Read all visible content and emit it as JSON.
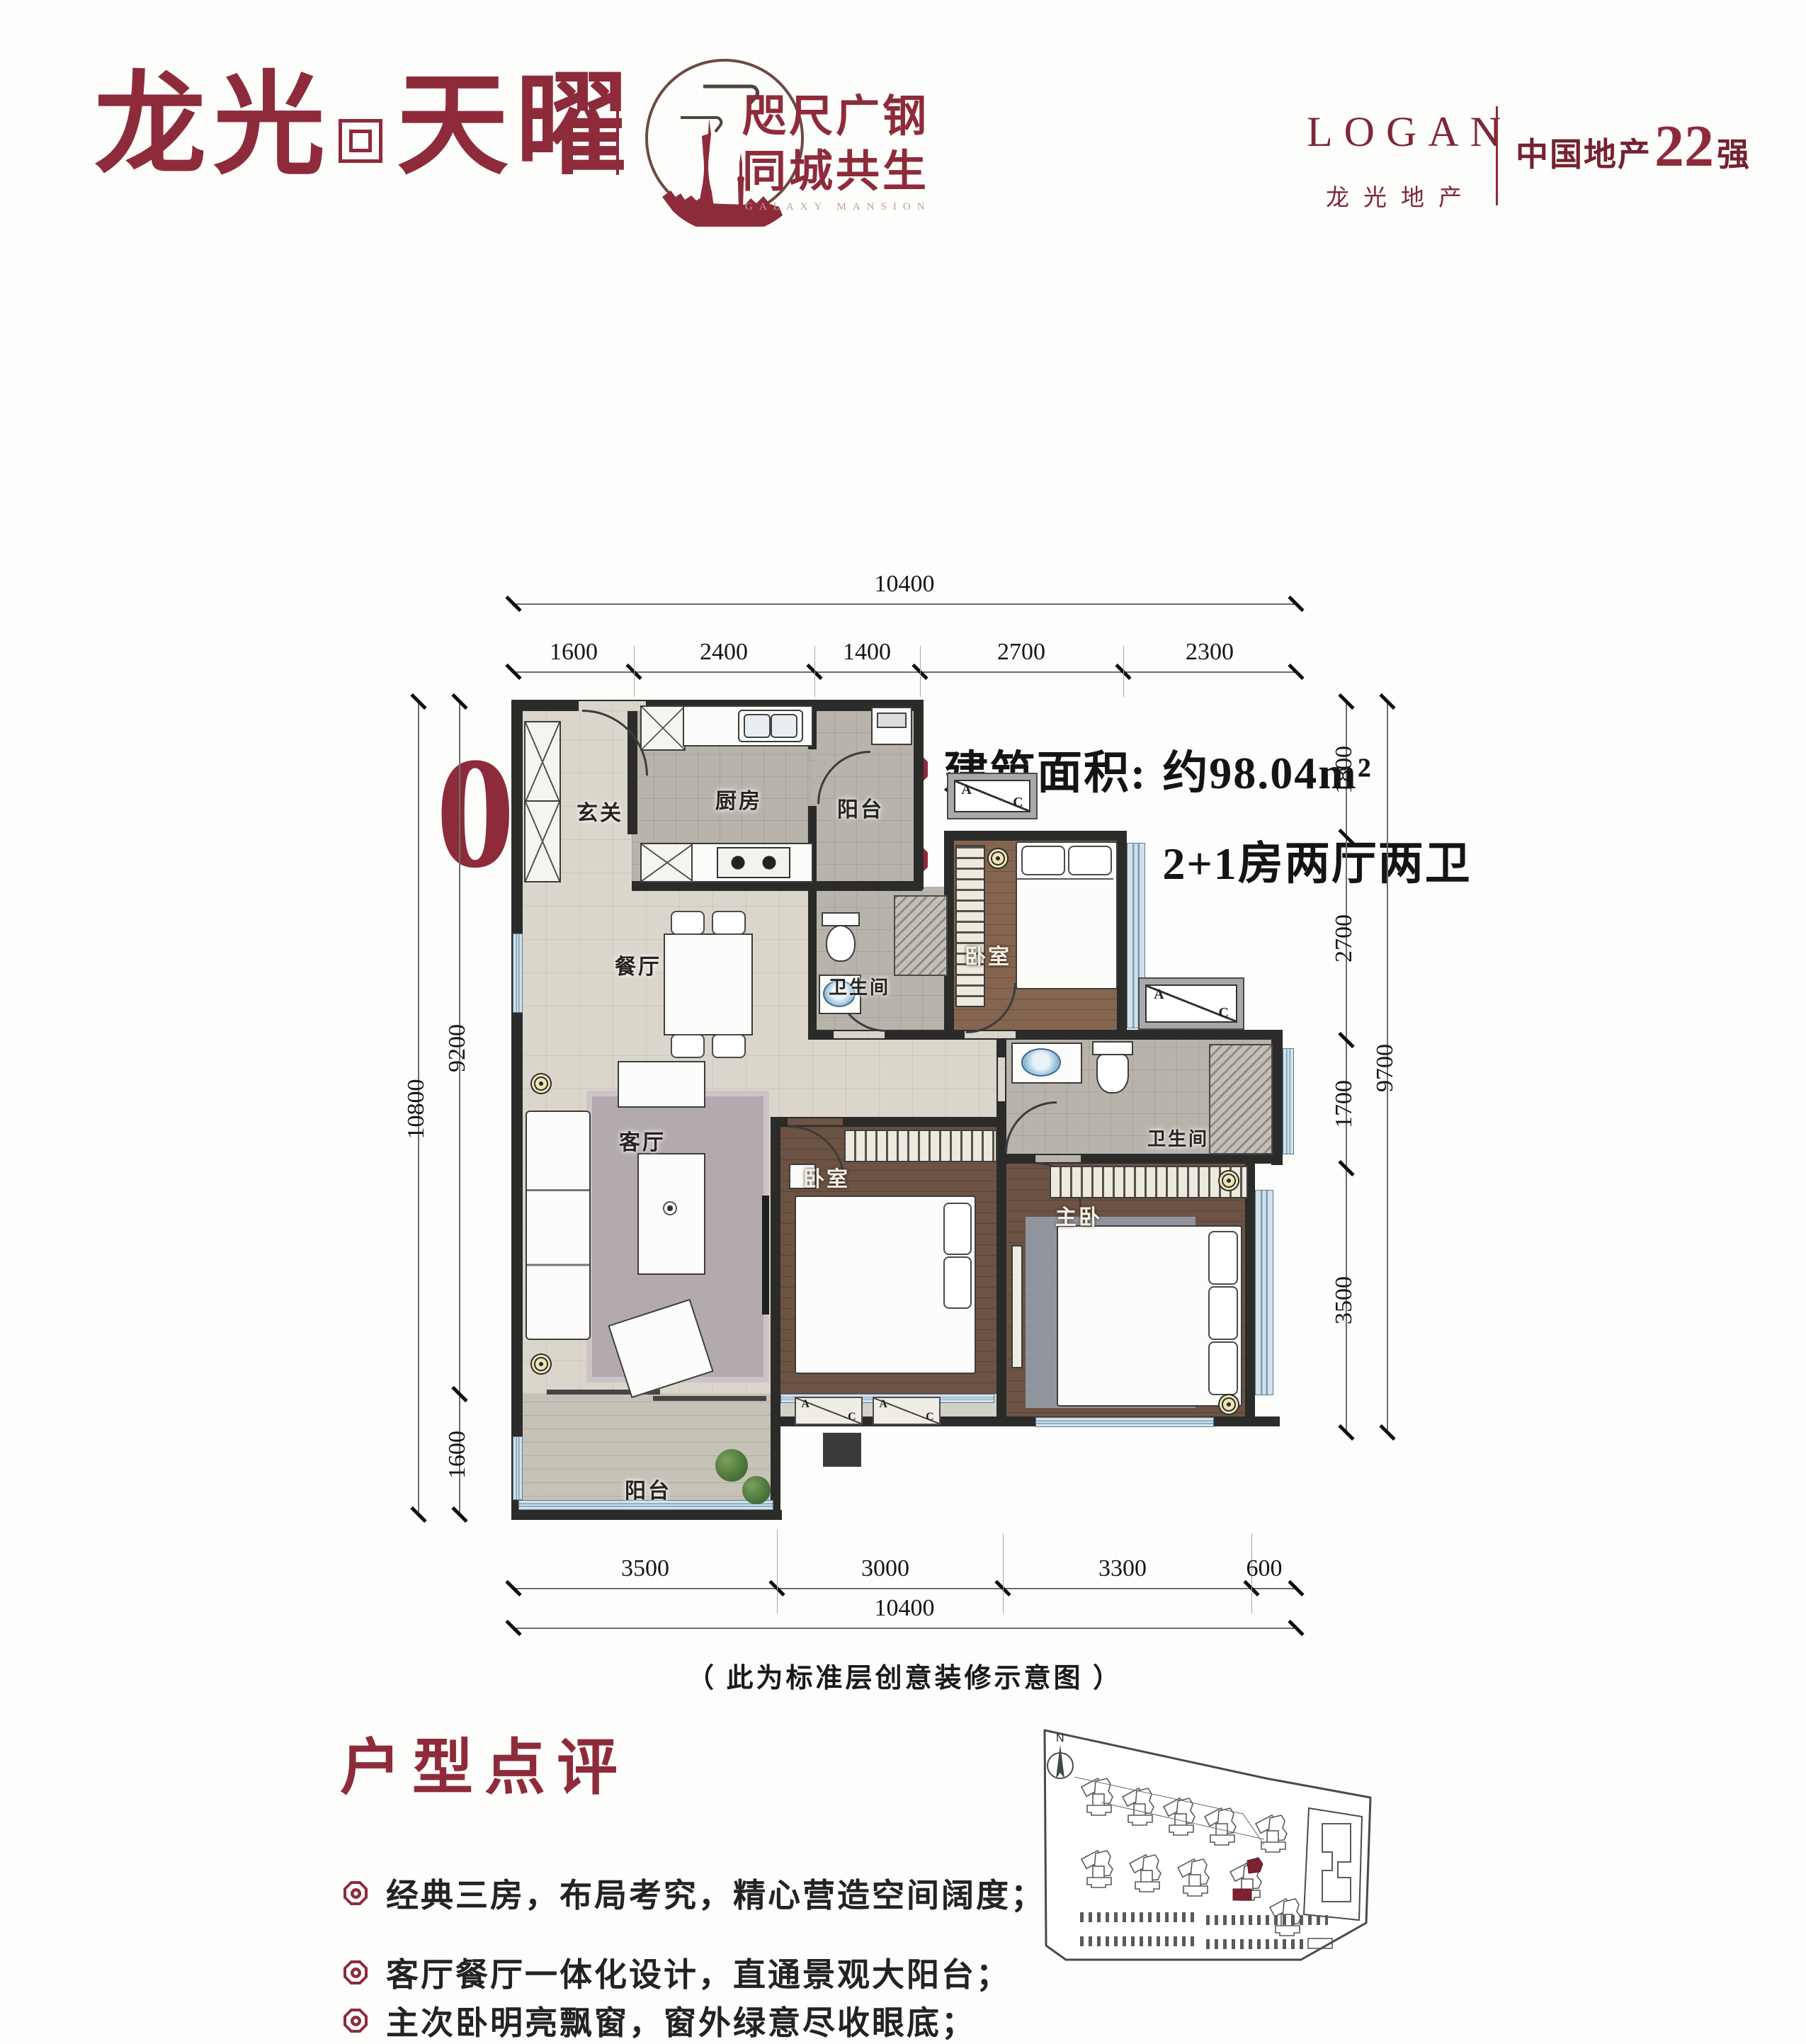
{
  "header": {
    "brand_first": "龙光",
    "brand_second": "天曜",
    "stamp": {
      "line1": "咫尺广钢",
      "line2": "同城共生",
      "subtitle": "GALAXY MANSION"
    },
    "logan": {
      "name": "LOGAN",
      "sub": "龙光地产"
    },
    "rank": {
      "prefix": "中国地产",
      "number": "22",
      "suffix": "强"
    }
  },
  "title": {
    "unit": "02/05",
    "unit_type": "户型",
    "specs": [
      {
        "label": "建筑面积:",
        "value": "约98.04m²"
      },
      {
        "label": "户型格局:",
        "value": "2+1房两厅两卫"
      }
    ]
  },
  "plan": {
    "rooms": {
      "entry": "玄关",
      "kitchen": "厨房",
      "balcony_top": "阳台",
      "bath_1": "卫生间",
      "dining": "餐厅",
      "living": "客厅",
      "bedroom_1": "卧室",
      "bedroom_2": "卧室",
      "master": "主卧",
      "bath_2": "卫生间",
      "balcony": "阳台"
    },
    "ac_a": "A",
    "ac_c": "C",
    "compass": "N",
    "note": "（ 此为标准层创意装修示意图 ）"
  },
  "dims": {
    "top_total": "10400",
    "top_segments": [
      "1600",
      "2400",
      "1400",
      "2700",
      "2300"
    ],
    "left_total": "10800",
    "left_segments": [
      "9200",
      "1600"
    ],
    "right_total": "9700",
    "right_segments": [
      "1800",
      "2700",
      "1700",
      "3500"
    ],
    "bottom_total": "10400",
    "bottom_segments": [
      "3500",
      "3000",
      "3300",
      "600"
    ]
  },
  "review": {
    "title": "户型点评",
    "bullets": [
      "经典三房，布局考究，精心营造空间阔度；",
      "客厅餐厅一体化设计，直通景观大阳台；",
      "主次卧明亮飘窗，窗外绿意尽收眼底；"
    ]
  },
  "colors": {
    "accent": "#8e2b3a",
    "ink": "#1c1c1c"
  }
}
